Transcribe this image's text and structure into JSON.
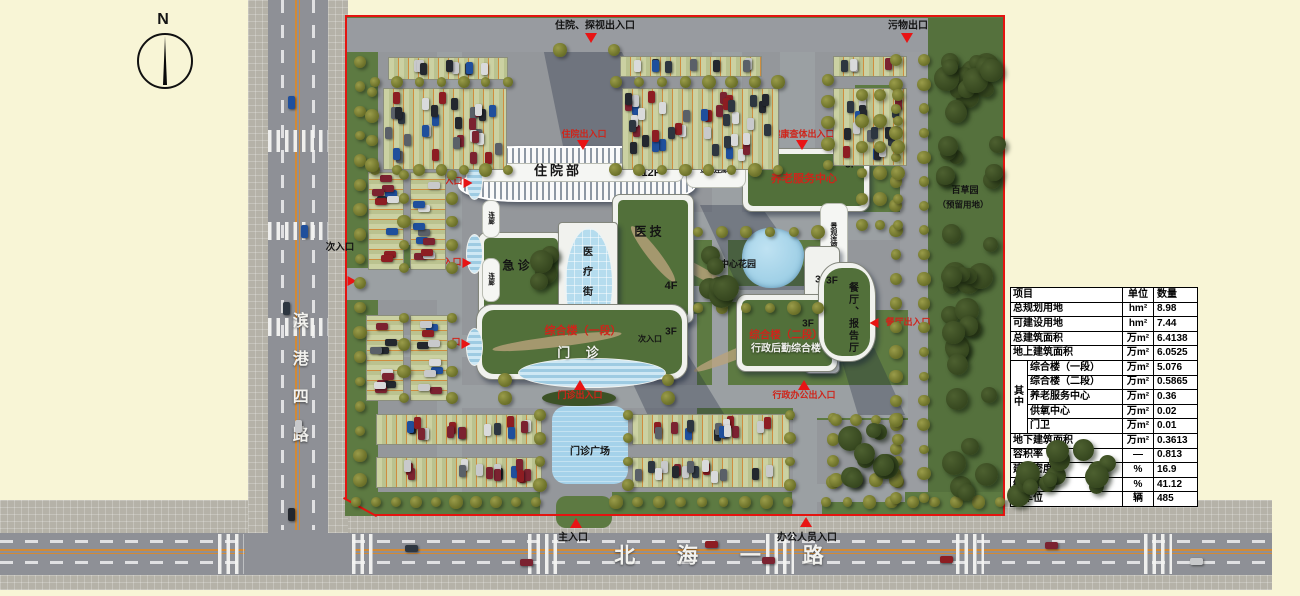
{
  "compass": {
    "label": "N"
  },
  "roads": {
    "left_name": "滨港四路",
    "bottom_name": "北 海 一 路"
  },
  "entrances": {
    "inpatient_visit": "住院、探视出入口",
    "waste_exit": "污物出口",
    "inpatient": "住院出入口",
    "health_check": "健康查体出入口",
    "fever": "发热出入口",
    "emergency": "急诊出入口",
    "pediatrics": "儿科出入口",
    "secondary_west": "次入口",
    "outpatient": "门诊出入口",
    "admin_office": "行政办公出入口",
    "canteen": "餐厅出入口",
    "main": "主入口",
    "office_staff": "办公人员入口"
  },
  "buildings": {
    "inpatient": {
      "name": "住院部",
      "floors": "12F"
    },
    "medtech": {
      "name": "医 技",
      "floors": "4F"
    },
    "emergency": {
      "name": "急  诊"
    },
    "medical_street": "医疗街",
    "outpatient": {
      "wing": "综合楼（一段）",
      "name": "门  诊",
      "floors": "3F",
      "side_entrance": "次入口"
    },
    "admin": {
      "wing": "综合楼（二段）",
      "name": "行政后勤综合楼",
      "floors": "3F",
      "tower_floors": "3F"
    },
    "canteen": {
      "name": "餐厅、报告厅",
      "floors": "3F"
    },
    "eldercare": {
      "name": "养老服务中心",
      "floors": "3F"
    },
    "corridor": "连廊",
    "scenic_corridor": "景观连廊",
    "central_garden": "中心花园",
    "outpatient_plaza": "门诊广场",
    "herb_garden_line1": "百草园",
    "herb_garden_line2": "（预留用地）"
  },
  "table": {
    "headers": [
      "项目",
      "单位",
      "数量"
    ],
    "group_label": "其中",
    "rows": [
      {
        "name": "总规划用地",
        "unit": "hm²",
        "qty": "8.98",
        "sub": false
      },
      {
        "name": "可建设用地",
        "unit": "hm²",
        "qty": "7.44",
        "sub": false
      },
      {
        "name": "总建筑面积",
        "unit": "万m²",
        "qty": "6.4138",
        "sub": false
      },
      {
        "name": "地上建筑面积",
        "unit": "万m²",
        "qty": "6.0525",
        "sub": false
      },
      {
        "name": "综合楼（一段）",
        "unit": "万m²",
        "qty": "5.076",
        "sub": true
      },
      {
        "name": "综合楼（二段）",
        "unit": "万m²",
        "qty": "0.5865",
        "sub": true
      },
      {
        "name": "养老服务中心",
        "unit": "万m²",
        "qty": "0.36",
        "sub": true
      },
      {
        "name": "供氧中心",
        "unit": "万m²",
        "qty": "0.02",
        "sub": true
      },
      {
        "name": "门卫",
        "unit": "万m²",
        "qty": "0.01",
        "sub": true
      },
      {
        "name": "地下建筑面积",
        "unit": "万m²",
        "qty": "0.3613",
        "sub": false
      },
      {
        "name": "容积率",
        "unit": "—",
        "qty": "0.813",
        "sub": false
      },
      {
        "name": "建筑密度",
        "unit": "%",
        "qty": "16.9",
        "sub": false
      },
      {
        "name": "绿地率",
        "unit": "%",
        "qty": "41.12",
        "sub": false
      },
      {
        "name": "停车位",
        "unit": "辆",
        "qty": "485",
        "sub": false
      }
    ]
  },
  "colors": {
    "boundary_red": "#e41410",
    "label_red": "#cf241a",
    "roof_green": "#52703a",
    "grass_green": "#5d7a42",
    "water_blue": "#a5d2ea",
    "road_gray": "#8e9096",
    "cream_bg": "#f8f5d6"
  }
}
